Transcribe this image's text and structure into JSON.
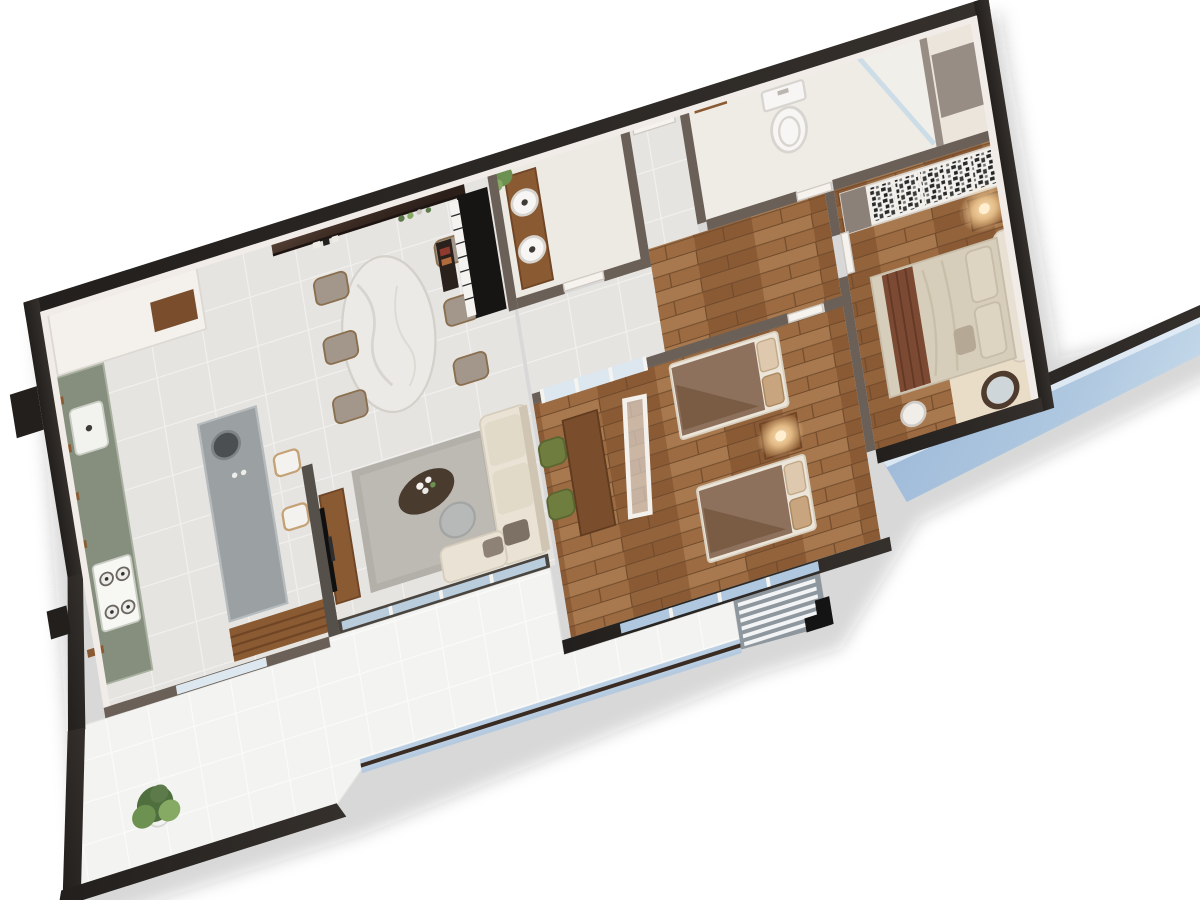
{
  "scene": {
    "kind": "3d-floorplan-cutaway-render",
    "view": "rotated top-down isometric, two-bedroom apartment",
    "background": "#FFFFFF"
  },
  "palette": {
    "wall_outer": "#221F1D",
    "wall_outer_hi": "#3C3835",
    "wall_face": "#F1ECE7",
    "wall_inner": "#6B6057",
    "wall_inner_light": "#978D84",
    "tile": "#E6E4E1",
    "tile_grout": "#F2F1EF",
    "wood": "#9C6B42",
    "wood_dark": "#7D5233",
    "balcony_tile": "#F3F3F1",
    "balcony_grout": "#FBFBFA",
    "glass_blue": "#AFC8E0",
    "glass_pale": "#DCE7EF",
    "handrail": "#3A2C22",
    "counter_green": "#868F7E",
    "island_gray": "#9BA1A3",
    "cabinet_white": "#F4F1ED",
    "marble": "#ECEAE6",
    "chair_taupe": "#A3968A",
    "piano_black": "#171513",
    "piano_keys": "#F5F3EF",
    "feature_dark": "#2C1F1A",
    "feature_light": "#5A4338",
    "sofa_cream": "#EAE3D5",
    "rug_gray": "#B3B0AA",
    "rug_inner": "#BDBAB4",
    "furniture_wood": "#8A5A32",
    "tv_black": "#101010",
    "duvet_brown": "#8D715C",
    "duvet_fold": "#7A5C44",
    "bed_base": "#ECE5D9",
    "pillow": "#DEC9AE",
    "master_duvet": "#D6CDBB",
    "runner_brown": "#7C4A33",
    "headboard": "#E8E0D2",
    "chair_green": "#6F7D3F",
    "plant_green": "#4F6F3F",
    "plant_light": "#86A964",
    "glow": "#FFD9A0",
    "wardrobe_white": "#F2EFEB",
    "louver_gray": "#8F979E",
    "fixture_white": "#F7F6F4",
    "fixture_line": "#D8D4CF",
    "mat_beige": "#E9DDC8",
    "mirror_frame": "#4E3B2D",
    "black": "#141414"
  },
  "rooms": [
    {
      "id": "kitchen",
      "label": "kitchen",
      "furniture": [
        "tall-white-cabinets",
        "fridge-niche",
        "green-counter-with-double-sink",
        "gas-hob",
        "wall-shelves",
        "concrete-island",
        "two-bar-stools",
        "slatted-wood-bench"
      ]
    },
    {
      "id": "dining-area",
      "label": "dining area",
      "furniture": [
        "glossy-brown-feature-wall",
        "bottle-shelf",
        "oval-marble-table",
        "six-taupe-chairs"
      ]
    },
    {
      "id": "piano-corner",
      "label": "piano corner",
      "furniture": [
        "upright-piano",
        "piano-bench"
      ]
    },
    {
      "id": "bathroom-1",
      "label": "guest bathroom",
      "furniture": [
        "wood-vanity",
        "two-vessel-sinks",
        "plant",
        "white-door"
      ]
    },
    {
      "id": "entry-hall",
      "label": "entry hall",
      "furniture": [
        "entry-door"
      ]
    },
    {
      "id": "bathroom-2",
      "label": "master bathroom",
      "furniture": [
        "toilet",
        "glass-shower",
        "towel-bar"
      ]
    },
    {
      "id": "hallway",
      "label": "hallway",
      "furniture": []
    },
    {
      "id": "bedroom-kids",
      "label": "twin bedroom",
      "furniture": [
        "two-single-beds",
        "shared-nightstand-with-lamp",
        "wood-desk",
        "two-green-chairs",
        "standing-mirror-frame",
        "glazed-partition"
      ]
    },
    {
      "id": "master-bedroom",
      "label": "master bedroom",
      "furniture": [
        "patterned-wardrobe",
        "nightstand-with-lamp",
        "double-bed-with-runner",
        "round-stool",
        "leaning-round-mirror",
        "beige-mat"
      ]
    },
    {
      "id": "living-room",
      "label": "living room",
      "furniture": [
        "l-shaped-cream-sofa",
        "gray-rug",
        "dark-organic-coffee-table",
        "round-side-table",
        "tv-on-wood-console",
        "sliding-glass-doors"
      ]
    },
    {
      "id": "service-balcony",
      "label": "service balcony",
      "furniture": [
        "potted-plant"
      ]
    },
    {
      "id": "main-balcony",
      "label": "main balcony",
      "furniture": [
        "glass-railing-with-wood-handrail"
      ]
    },
    {
      "id": "ac-ledge",
      "label": "louvered AC ledge",
      "furniture": [
        "white-louver-slats",
        "black-corner-wall"
      ]
    },
    {
      "id": "window-bay",
      "label": "master glass window bay",
      "furniture": [
        "blue-glazing-band"
      ]
    }
  ]
}
